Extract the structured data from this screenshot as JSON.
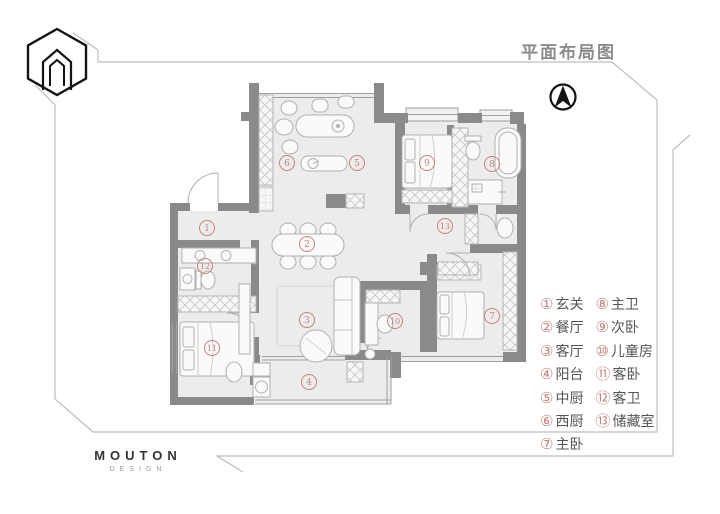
{
  "header": {
    "title": "平面布局图"
  },
  "brand": {
    "name": "MOUTON",
    "tagline": "DESIGN"
  },
  "legend": {
    "items": [
      {
        "num": "①",
        "label": "玄关"
      },
      {
        "num": "②",
        "label": "餐厅"
      },
      {
        "num": "③",
        "label": "客厅"
      },
      {
        "num": "④",
        "label": "阳台"
      },
      {
        "num": "⑤",
        "label": "中厨"
      },
      {
        "num": "⑥",
        "label": "西厨"
      },
      {
        "num": "⑦",
        "label": "主卧"
      },
      {
        "num": "⑧",
        "label": "主卫"
      },
      {
        "num": "⑨",
        "label": "次卧"
      },
      {
        "num": "⑩",
        "label": "儿童房"
      },
      {
        "num": "⑪",
        "label": "客卧"
      },
      {
        "num": "⑫",
        "label": "客卫"
      },
      {
        "num": "⑬",
        "label": "储藏室"
      }
    ]
  },
  "plan": {
    "markers": [
      {
        "num": "1"
      },
      {
        "num": "2"
      },
      {
        "num": "3"
      },
      {
        "num": "4"
      },
      {
        "num": "5"
      },
      {
        "num": "6"
      },
      {
        "num": "7"
      },
      {
        "num": "8"
      },
      {
        "num": "9"
      },
      {
        "num": "10"
      },
      {
        "num": "11"
      },
      {
        "num": "12"
      },
      {
        "num": "13"
      }
    ]
  },
  "colors": {
    "accent": "#c2837d",
    "wall": "#8a8a8a",
    "floor": "#ececec",
    "furniture_line": "#b0b0b0",
    "frame_line": "#bdbdbd",
    "title_text": "#8c8c8c",
    "legend_text": "#565656"
  }
}
